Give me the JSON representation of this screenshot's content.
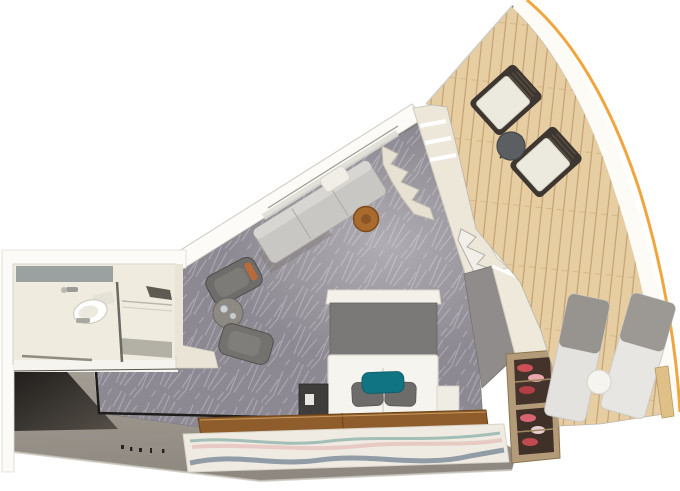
{
  "meta": {
    "title": "3D top-down floor plan render of a ship cabin with balcony",
    "canvas": {
      "width": 680,
      "height": 491
    }
  },
  "colors": {
    "background": "#ffffff",
    "carpet_base": "#8d8992",
    "carpet_pattern": "#bfbbc4",
    "deck_base": "#e7cda2",
    "deck_plank_line": "#c2a273",
    "hull_stripe": "#f0a63e",
    "wall_white": "#fcfbf8",
    "wall_cream": "#e9e4d6",
    "wall_taupe_top": "#a39d94",
    "wall_taupe_bottom": "#8e8880",
    "wall_charcoal": "#1d1b19",
    "bathroom_floor": "#efebdf",
    "vanity_gray": "#9ba1a1",
    "shower_tray": "#b3b0a6",
    "sofa_gray": "#c9c7c3",
    "sofa_cushion_white": "#f1eee7",
    "armchair_gray": "#6f6d6b",
    "drum_table_brown": "#a96a2d",
    "coffee_table_gray": "#8d8a84",
    "bed_white": "#f6f4ef",
    "headboard_gray": "#7b7977",
    "pillow_gray": "#6e6c6a",
    "pillow_teal": "#117483",
    "nightstand_dark": "#3f3d3b",
    "nightstand_white": "#efece4",
    "wood_floor": "#8f5d2b",
    "rug_cream": "#f0ebe2",
    "rug_wave_teal": "#8fb3ac",
    "rug_wave_pink": "#e3bcb6",
    "rug_wave_blue": "#8794a0",
    "wardrobe_cream": "#ece7d8",
    "console_cream": "#eee9db",
    "inner_wall_gray": "#8f8c8b",
    "shelf_frame_tan": "#b39b79",
    "shelf_interior": "#43332a",
    "shelf_item_red": "#cc4f57",
    "shelf_item_pink": "#e8a7ad",
    "balcony_chair_cushion": "#eceade",
    "balcony_chair_frame": "#3e3630",
    "balcony_table_gray": "#5c5f61",
    "lounger_light": "#e3e2de",
    "lounger_gray": "#97948f",
    "side_table_white": "#f6f4ee",
    "hull_inner_tan": "#dfc188"
  },
  "scene": {
    "rooms": [
      {
        "name": "bathroom",
        "contents": [
          "vanity counter",
          "toilet",
          "sink faucet",
          "glass shower screen",
          "shower tray",
          "towel rail"
        ]
      },
      {
        "name": "entry corridor",
        "contents": [
          "shadowed entry wall",
          "scale marks"
        ]
      },
      {
        "name": "living area",
        "contents": [
          "sofa with white cushion",
          "round drum side table",
          "two gray armchairs",
          "round coffee table with cups"
        ]
      },
      {
        "name": "bedroom",
        "contents": [
          "double bed",
          "gray headboard",
          "two gray pillows",
          "teal accent pillow",
          "dark nightstand",
          "white nightstand",
          "round stool"
        ]
      },
      {
        "name": "storage wall",
        "contents": [
          "wardrobe with shelves",
          "stepped shelf unit",
          "accordion glass door",
          "gray inner wall",
          "cream console",
          "shoe shelf with red shoes"
        ]
      },
      {
        "name": "balcony",
        "contents": [
          "timber deck",
          "two deck chairs",
          "round bistro table",
          "two sun loungers",
          "white side table",
          "curved ship hull band with orange stripe"
        ]
      }
    ],
    "floor_finishes": [
      "patterned gray carpet",
      "timber deck planks",
      "wood floor strip",
      "cream rug with wavy teal, pink and blue stripes"
    ]
  }
}
